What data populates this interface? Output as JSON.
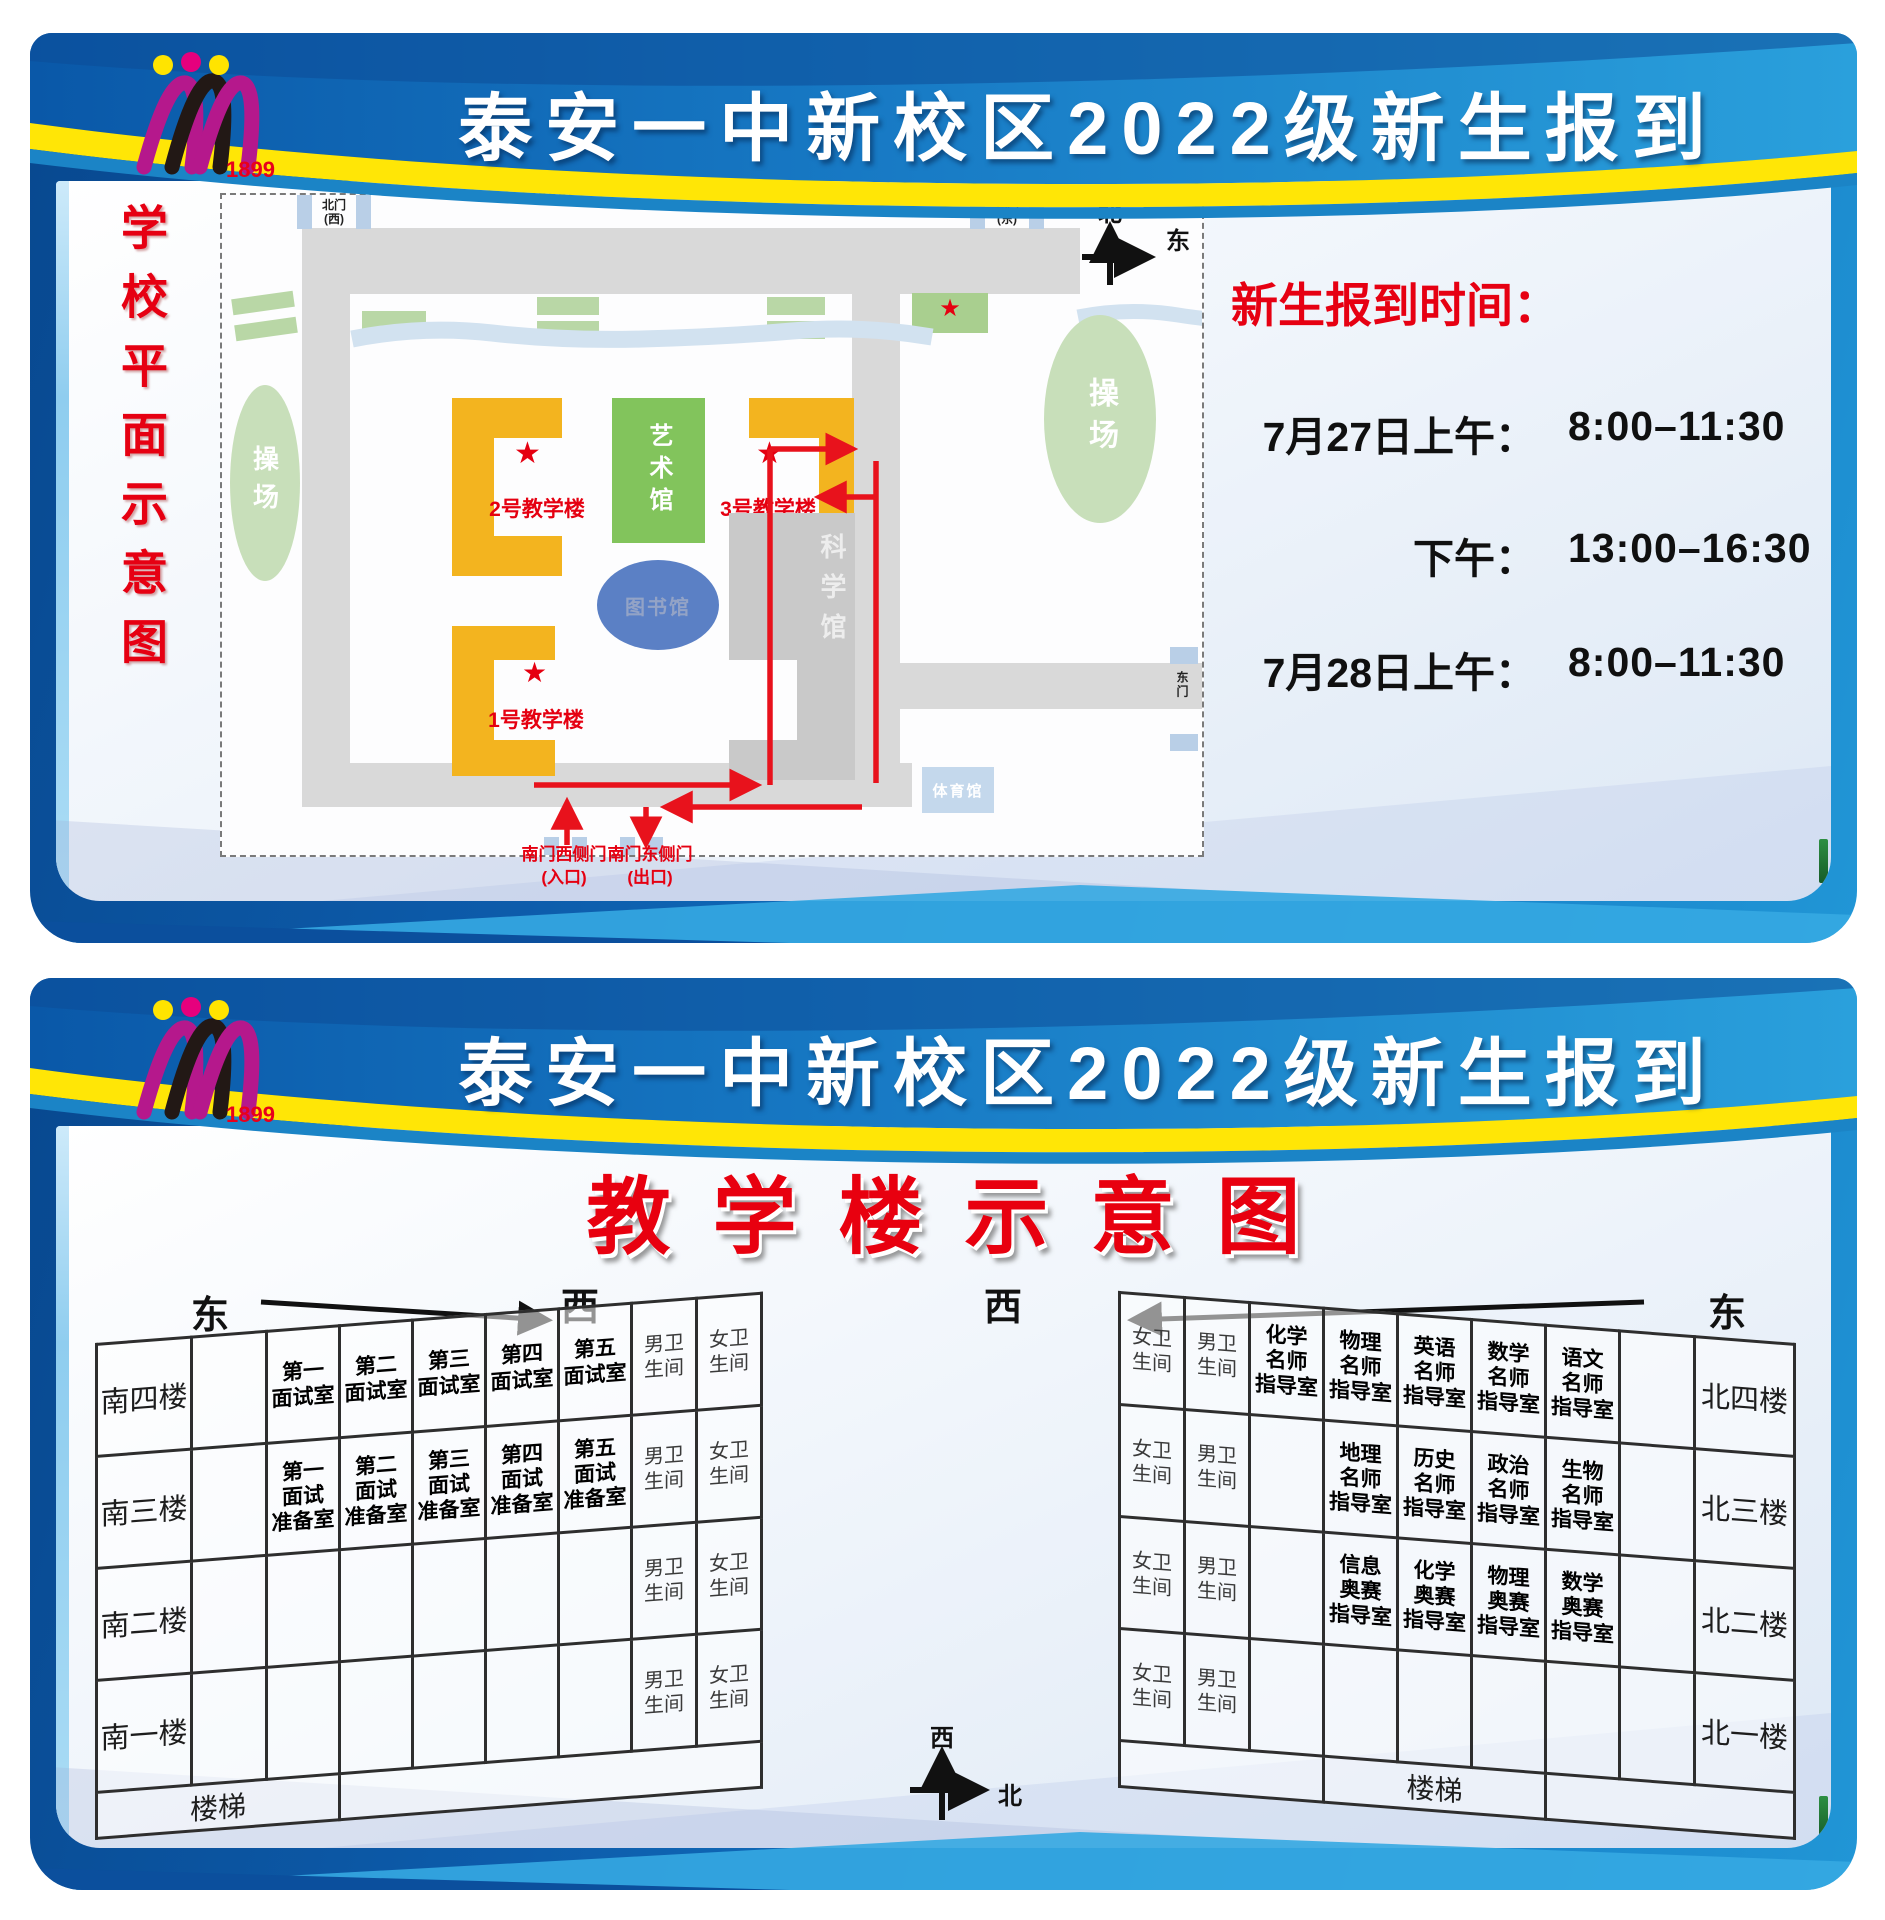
{
  "colors": {
    "frame_blue": "#0d5cab",
    "header_blue": "#1172bf",
    "ribbon_yellow": "#ffe606",
    "accent_red": "#e60012",
    "building_yellow": "#f3b41f",
    "art_green": "#82c45c",
    "playground_green": "#c8dfba",
    "library_blue": "#5b80c5",
    "road_gray": "#d9d9d9",
    "gate_blue": "#b9cfe7",
    "route_red": "#e8121c"
  },
  "header": {
    "title": "泰安一中新校区2022级新生报到",
    "logo_year": "1899"
  },
  "poster1": {
    "side_title": "学校平面示意图",
    "map": {
      "gates": {
        "north_west": [
          "北门",
          "(西)"
        ],
        "north_east": [
          "北门",
          "(东)"
        ],
        "east": "东门",
        "south_west": [
          "南门西侧门",
          "(入口)"
        ],
        "south_east": [
          "南门东侧门",
          "(出口)"
        ]
      },
      "compass": {
        "north": "北",
        "east": "东"
      },
      "labels": {
        "playground_left": "操场",
        "playground_right": "操场",
        "art": "艺术馆",
        "library": "图书馆",
        "science": "科学馆",
        "gym": "体育馆",
        "teach1": "1号教学楼",
        "teach2": "2号教学楼",
        "teach3": "3号教学楼"
      }
    },
    "schedule": {
      "title": "新生报到时间：",
      "rows": [
        {
          "label": "7月27日上午：",
          "time": "8:00–11:30"
        },
        {
          "label": "下午：",
          "time": "13:00–16:30"
        },
        {
          "label": "7月28日上午：",
          "time": "8:00–11:30"
        }
      ]
    }
  },
  "poster2": {
    "title": "教学楼示意图",
    "directions": {
      "east_left": "东",
      "west_left": "西",
      "west_right": "西",
      "east_right": "东"
    },
    "compass": {
      "west": "西",
      "north": "北"
    },
    "left_table": {
      "rows": [
        {
          "floor": "南四楼",
          "cells": [
            "",
            [
              "第一",
              "面试室"
            ],
            [
              "第二",
              "面试室"
            ],
            [
              "第三",
              "面试室"
            ],
            [
              "第四",
              "面试室"
            ],
            [
              "第五",
              "面试室"
            ],
            [
              "男卫",
              "生间"
            ],
            [
              "女卫",
              "生间"
            ]
          ]
        },
        {
          "floor": "南三楼",
          "cells": [
            "",
            [
              "第一",
              "面试",
              "准备室"
            ],
            [
              "第二",
              "面试",
              "准备室"
            ],
            [
              "第三",
              "面试",
              "准备室"
            ],
            [
              "第四",
              "面试",
              "准备室"
            ],
            [
              "第五",
              "面试",
              "准备室"
            ],
            [
              "男卫",
              "生间"
            ],
            [
              "女卫",
              "生间"
            ]
          ]
        },
        {
          "floor": "南二楼",
          "cells": [
            "",
            "",
            "",
            "",
            "",
            "",
            [
              "男卫",
              "生间"
            ],
            [
              "女卫",
              "生间"
            ]
          ]
        },
        {
          "floor": "南一楼",
          "cells": [
            "",
            "",
            "",
            "",
            "",
            "",
            [
              "男卫",
              "生间"
            ],
            [
              "女卫",
              "生间"
            ]
          ]
        }
      ],
      "stairs": "楼梯"
    },
    "right_table": {
      "rows": [
        {
          "floor": "北四楼",
          "cells": [
            [
              "女卫",
              "生间"
            ],
            [
              "男卫",
              "生间"
            ],
            [
              "化学",
              "名师",
              "指导室"
            ],
            [
              "物理",
              "名师",
              "指导室"
            ],
            [
              "英语",
              "名师",
              "指导室"
            ],
            [
              "数学",
              "名师",
              "指导室"
            ],
            [
              "语文",
              "名师",
              "指导室"
            ],
            ""
          ]
        },
        {
          "floor": "北三楼",
          "cells": [
            [
              "女卫",
              "生间"
            ],
            [
              "男卫",
              "生间"
            ],
            "",
            [
              "地理",
              "名师",
              "指导室"
            ],
            [
              "历史",
              "名师",
              "指导室"
            ],
            [
              "政治",
              "名师",
              "指导室"
            ],
            [
              "生物",
              "名师",
              "指导室"
            ],
            ""
          ]
        },
        {
          "floor": "北二楼",
          "cells": [
            [
              "女卫",
              "生间"
            ],
            [
              "男卫",
              "生间"
            ],
            "",
            [
              "信息",
              "奥赛",
              "指导室"
            ],
            [
              "化学",
              "奥赛",
              "指导室"
            ],
            [
              "物理",
              "奥赛",
              "指导室"
            ],
            [
              "数学",
              "奥赛",
              "指导室"
            ],
            ""
          ]
        },
        {
          "floor": "北一楼",
          "cells": [
            [
              "女卫",
              "生间"
            ],
            [
              "男卫",
              "生间"
            ],
            "",
            "",
            "",
            "",
            "",
            ""
          ]
        }
      ],
      "stairs": "楼梯"
    }
  }
}
